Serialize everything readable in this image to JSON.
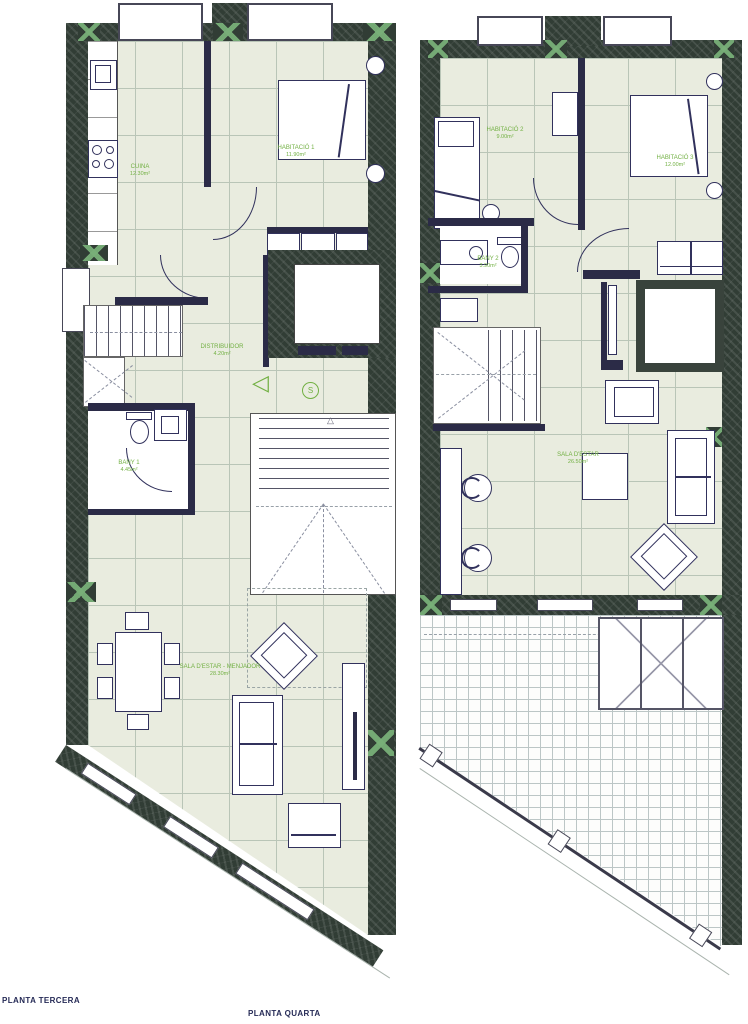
{
  "plans": {
    "tercera": {
      "title": "PLANTA TERCERA",
      "rooms": {
        "cuina": {
          "name": "CUINA",
          "area": "12.30m²"
        },
        "habitacio1": {
          "name": "HABITACIÓ 1",
          "area": "11.90m²"
        },
        "distribuidor": {
          "name": "DISTRIBUIDOR",
          "area": "4.20m²"
        },
        "bany1": {
          "name": "BANY 1",
          "area": "4.45m²"
        },
        "sala": {
          "name": "SALA D'ESTAR - MENJADOR",
          "area": "28.30m²"
        }
      },
      "symbols": {
        "evac_triangle": "◁",
        "siren_s": "S",
        "stair_marker": "△"
      }
    },
    "quarta": {
      "title": "PLANTA QUARTA",
      "rooms": {
        "habitacio2": {
          "name": "HABITACIÓ 2",
          "area": "9.00m²"
        },
        "habitacio3": {
          "name": "HABITACIÓ 3",
          "area": "12.00m²"
        },
        "bany2": {
          "name": "BANY 2",
          "area": "3.90m²"
        },
        "sala": {
          "name": "SALA D'ESTAR",
          "area": "26.50m²"
        }
      }
    }
  },
  "colors": {
    "wall": "#313d35",
    "floor": "#e9ecdf",
    "grid": "#b9c5b7",
    "line": "#31315c",
    "label_green": "#72b043",
    "title_navy": "#252a56"
  }
}
